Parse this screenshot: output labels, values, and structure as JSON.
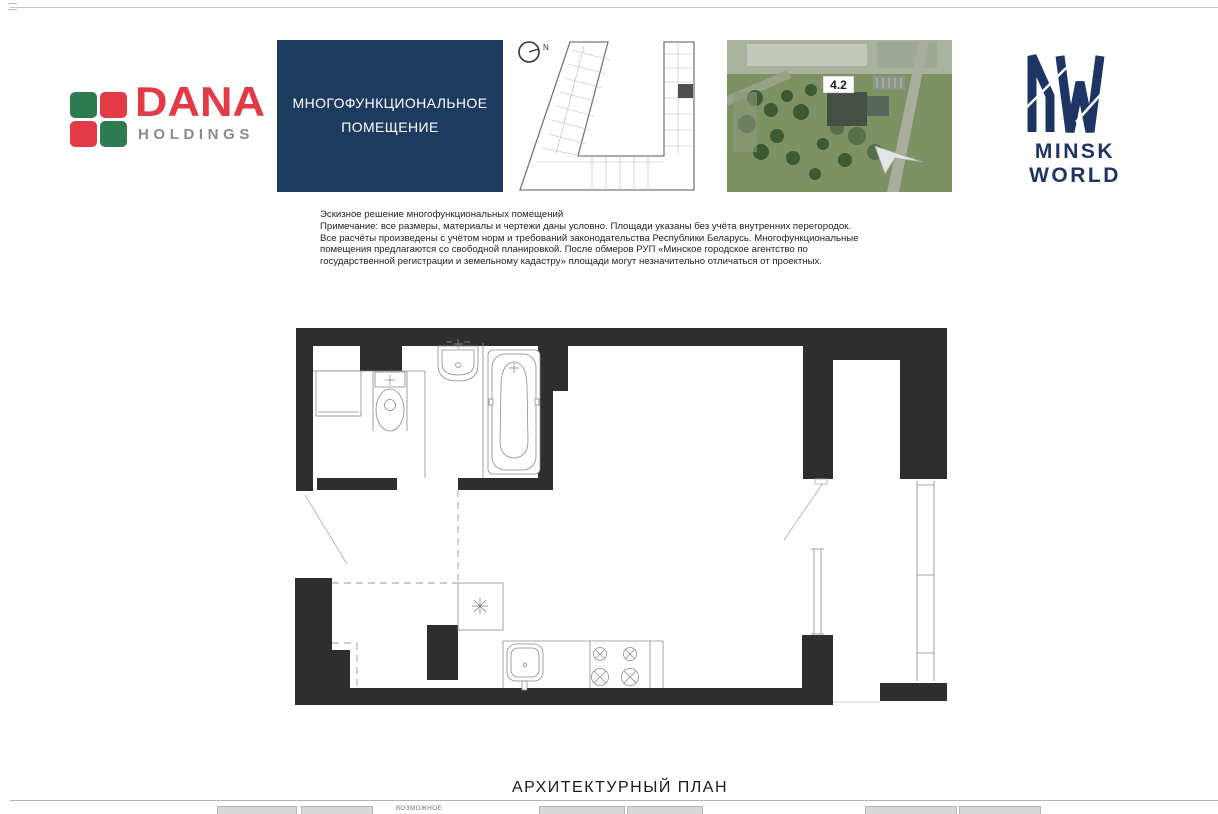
{
  "colors": {
    "wall": "#2e2e2e",
    "navy": "#1d3a5f",
    "mw_navy": "#1e3464",
    "dana_red": "#e23b45",
    "dana_green": "#2e7b50",
    "dana_gray": "#8a8a8a",
    "line_gray": "#8a8a8a"
  },
  "header": {
    "dana": {
      "brand": "DANA",
      "sub": "HOLDINGS"
    },
    "title_box": {
      "line1": "МНОГОФУНКЦИОНАЛЬНОЕ",
      "line2": "ПОМЕЩЕНИЕ"
    },
    "site_plan": {
      "north_label": "N"
    },
    "aerial": {
      "block_label": "4.2"
    },
    "minsk_world": {
      "brand": "MINSK WORLD"
    }
  },
  "note": {
    "lines": [
      "Эскизное решение многофункциональных помещений",
      "Примечание: все размеры, материалы и чертежи даны условно. Площади указаны без учёта внутренних перегородок.",
      "Все расчёты произведены с учётом норм и требований законодательства Республики Беларусь. Многофункциональные",
      "помещения предлагаются со свободной планировкой. После обмеров РУП «Минское городское агентство по",
      "государственной регистрации и земельному кадастру» площади могут незначительно отличаться от проектных."
    ]
  },
  "plan_title": "АРХИТЕКТУРНЫЙ ПЛАН",
  "footer": {
    "partial_label": "ВОЗМОЖНОЕ"
  }
}
